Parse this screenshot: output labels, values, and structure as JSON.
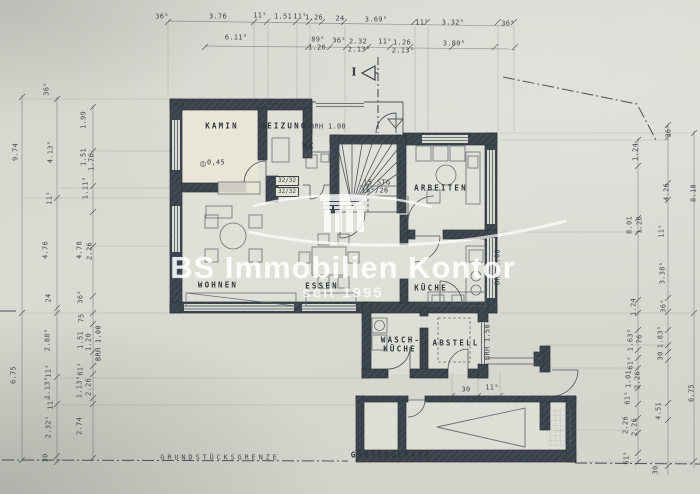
{
  "colors": {
    "paper": "#d6d8d0",
    "wall": "#39424a",
    "line": "#4d545b",
    "text": "#343b42",
    "watermark": "#ffffff",
    "kamin_floor": "#ebe7d7"
  },
  "watermark": {
    "brand": "BS Immobilien Kontor",
    "tagline": "seit 1995",
    "logo": "temple-columns-icon"
  },
  "plan": {
    "rooms": [
      {
        "id": "kamin",
        "t": "KAMIN",
        "x": 222,
        "y": 126
      },
      {
        "id": "heizung",
        "t": "HEIZUNG",
        "x": 284,
        "y": 126
      },
      {
        "id": "wc",
        "t": "WC",
        "x": 309,
        "y": 146
      },
      {
        "id": "arbeiten",
        "t": "ARBEITEN",
        "x": 441,
        "y": 188
      },
      {
        "id": "wohnen",
        "t": "WOHNEN",
        "x": 218,
        "y": 285
      },
      {
        "id": "essen",
        "t": "ESSEN",
        "x": 322,
        "y": 286
      },
      {
        "id": "kueche",
        "t": "KÜCHE",
        "x": 431,
        "y": 288
      },
      {
        "id": "wasch-kueche-line1",
        "t": "WASCH-",
        "x": 401,
        "y": 340
      },
      {
        "id": "wasch-kueche-line2",
        "t": "KÜCHE",
        "x": 400,
        "y": 349
      },
      {
        "id": "abstell",
        "t": "ABSTELL",
        "x": 456,
        "y": 343
      },
      {
        "id": "gartengeraete",
        "t": "GARTENGERÄTE",
        "x": 391,
        "y": 455
      }
    ],
    "annotations": [
      {
        "id": "brh-top",
        "t": "BRH 1.00",
        "x": 328,
        "y": 127,
        "cls": "ann"
      },
      {
        "id": "stair-count",
        "t": "15 STG",
        "x": 377,
        "y": 183,
        "cls": "ann"
      },
      {
        "id": "stair-ratio",
        "t": "18⁸/26",
        "x": 375,
        "y": 191,
        "cls": "ann"
      },
      {
        "id": "level-mark",
        "t": "0,45",
        "x": 216,
        "y": 163,
        "cls": "ann"
      },
      {
        "id": "lintel-1",
        "t": "32/32",
        "x": 287,
        "y": 181,
        "cls": "boxed"
      },
      {
        "id": "lintel-2",
        "t": "32/32",
        "x": 287,
        "y": 192,
        "cls": "boxed"
      },
      {
        "id": "brh-right",
        "t": "BRH 1.00",
        "x": 498,
        "y": 267,
        "cls": "annv"
      },
      {
        "id": "brh-annex",
        "t": "BRH 1.50",
        "x": 488,
        "y": 342,
        "cls": "annv"
      },
      {
        "id": "brh-left",
        "t": "BRH 1.00",
        "x": 99,
        "y": 343,
        "cls": "annv"
      },
      {
        "id": "section-mark",
        "t": "I",
        "x": 354,
        "y": 72,
        "cls": "section"
      },
      {
        "id": "boundary-label",
        "t": "GRUNDSTÜCKSGRENZE",
        "x": 220,
        "y": 458,
        "cls": "boundary"
      }
    ],
    "dims_top": [
      {
        "t": "36⁵",
        "x": 162,
        "y": 17
      },
      {
        "t": "3.76",
        "x": 218,
        "y": 17
      },
      {
        "t": "11⁵",
        "x": 260,
        "y": 16
      },
      {
        "t": "1.51",
        "x": 283,
        "y": 17
      },
      {
        "t": "11⁵",
        "x": 300,
        "y": 17
      },
      {
        "t": "1.26",
        "x": 314,
        "y": 18
      },
      {
        "t": "24",
        "x": 340,
        "y": 19
      },
      {
        "t": "3.69⁵",
        "x": 376,
        "y": 20
      },
      {
        "t": "11⁵",
        "x": 422,
        "y": 23
      },
      {
        "t": "3.32⁵",
        "x": 453,
        "y": 23
      },
      {
        "t": "36⁵",
        "x": 508,
        "y": 24
      }
    ],
    "dims_top2": [
      {
        "t": "6.11⁵",
        "x": 236,
        "y": 38
      },
      {
        "t": "89⁵",
        "x": 318,
        "y": 40
      },
      {
        "t": "1.26",
        "x": 317,
        "y": 48
      },
      {
        "t": "36⁵",
        "x": 339,
        "y": 41
      },
      {
        "t": "2.32",
        "x": 358,
        "y": 42
      },
      {
        "t": "2.13⁵",
        "x": 359,
        "y": 50
      },
      {
        "t": "11⁵",
        "x": 385,
        "y": 42
      },
      {
        "t": "1.26",
        "x": 402,
        "y": 43
      },
      {
        "t": "2.13⁵",
        "x": 403,
        "y": 51
      },
      {
        "t": "3.80⁵",
        "x": 454,
        "y": 44
      }
    ],
    "dims_small": [
      {
        "t": "30",
        "x": 466,
        "y": 390
      },
      {
        "t": "11⁵",
        "x": 492,
        "y": 388
      }
    ],
    "dims_left": [
      {
        "t": "9.74",
        "x": 16,
        "y": 152
      },
      {
        "t": "6.75",
        "x": 14,
        "y": 375
      },
      {
        "t": "36⁵",
        "x": 47,
        "y": 89
      },
      {
        "t": "4.13⁵",
        "x": 51,
        "y": 152
      },
      {
        "t": "11⁵",
        "x": 50,
        "y": 198
      },
      {
        "t": "4.76",
        "x": 46,
        "y": 250
      },
      {
        "t": "24",
        "x": 49,
        "y": 298
      },
      {
        "t": "2.88⁵",
        "x": 48,
        "y": 340
      },
      {
        "t": "11⁵",
        "x": 49,
        "y": 371
      },
      {
        "t": "1.13⁵",
        "x": 48,
        "y": 388
      },
      {
        "t": "11⁵",
        "x": 51,
        "y": 403
      },
      {
        "t": "2.32⁵",
        "x": 49,
        "y": 427
      },
      {
        "t": "30",
        "x": 46,
        "y": 458
      },
      {
        "t": "1.99",
        "x": 84,
        "y": 120
      },
      {
        "t": "1.51",
        "x": 84,
        "y": 157
      },
      {
        "t": "1.76",
        "x": 92,
        "y": 162
      },
      {
        "t": "1.11⁵",
        "x": 86,
        "y": 188
      },
      {
        "t": "4.78",
        "x": 80,
        "y": 250
      },
      {
        "t": "2.26",
        "x": 90,
        "y": 251
      },
      {
        "t": "36⁵",
        "x": 81,
        "y": 297
      },
      {
        "t": "75",
        "x": 82,
        "y": 318
      },
      {
        "t": "1.51",
        "x": 81,
        "y": 340
      },
      {
        "t": "1.20",
        "x": 89,
        "y": 342
      },
      {
        "t": "61⁵",
        "x": 81,
        "y": 369
      },
      {
        "t": "1.13⁵",
        "x": 80,
        "y": 387
      },
      {
        "t": "2.26",
        "x": 89,
        "y": 387
      },
      {
        "t": "2.74",
        "x": 80,
        "y": 426
      }
    ],
    "dims_right": [
      {
        "t": "36⁵",
        "x": 669,
        "y": 131
      },
      {
        "t": "1.24",
        "x": 636,
        "y": 152
      },
      {
        "t": "4.26",
        "x": 667,
        "y": 192
      },
      {
        "t": "8.18",
        "x": 694,
        "y": 193
      },
      {
        "t": "8.01",
        "x": 630,
        "y": 225
      },
      {
        "t": "1.26",
        "x": 640,
        "y": 225
      },
      {
        "t": "11⁵",
        "x": 662,
        "y": 231
      },
      {
        "t": "3.38⁵",
        "x": 663,
        "y": 273
      },
      {
        "t": "1.24",
        "x": 634,
        "y": 307
      },
      {
        "t": "36⁵",
        "x": 664,
        "y": 306
      },
      {
        "t": "1.63⁵",
        "x": 631,
        "y": 340
      },
      {
        "t": "76",
        "x": 640,
        "y": 339
      },
      {
        "t": "1.83⁵",
        "x": 661,
        "y": 337
      },
      {
        "t": "30",
        "x": 661,
        "y": 356
      },
      {
        "t": "61⁵",
        "x": 631,
        "y": 363
      },
      {
        "t": "1.01",
        "x": 629,
        "y": 379
      },
      {
        "t": "2.26",
        "x": 638,
        "y": 380
      },
      {
        "t": "6.75",
        "x": 692,
        "y": 393
      },
      {
        "t": "61⁵",
        "x": 628,
        "y": 398
      },
      {
        "t": "4.51",
        "x": 659,
        "y": 411
      },
      {
        "t": "2.26",
        "x": 626,
        "y": 425
      },
      {
        "t": "2.26",
        "x": 635,
        "y": 427
      },
      {
        "t": "61⁵",
        "x": 627,
        "y": 458
      },
      {
        "t": "30",
        "x": 656,
        "y": 470
      }
    ]
  }
}
